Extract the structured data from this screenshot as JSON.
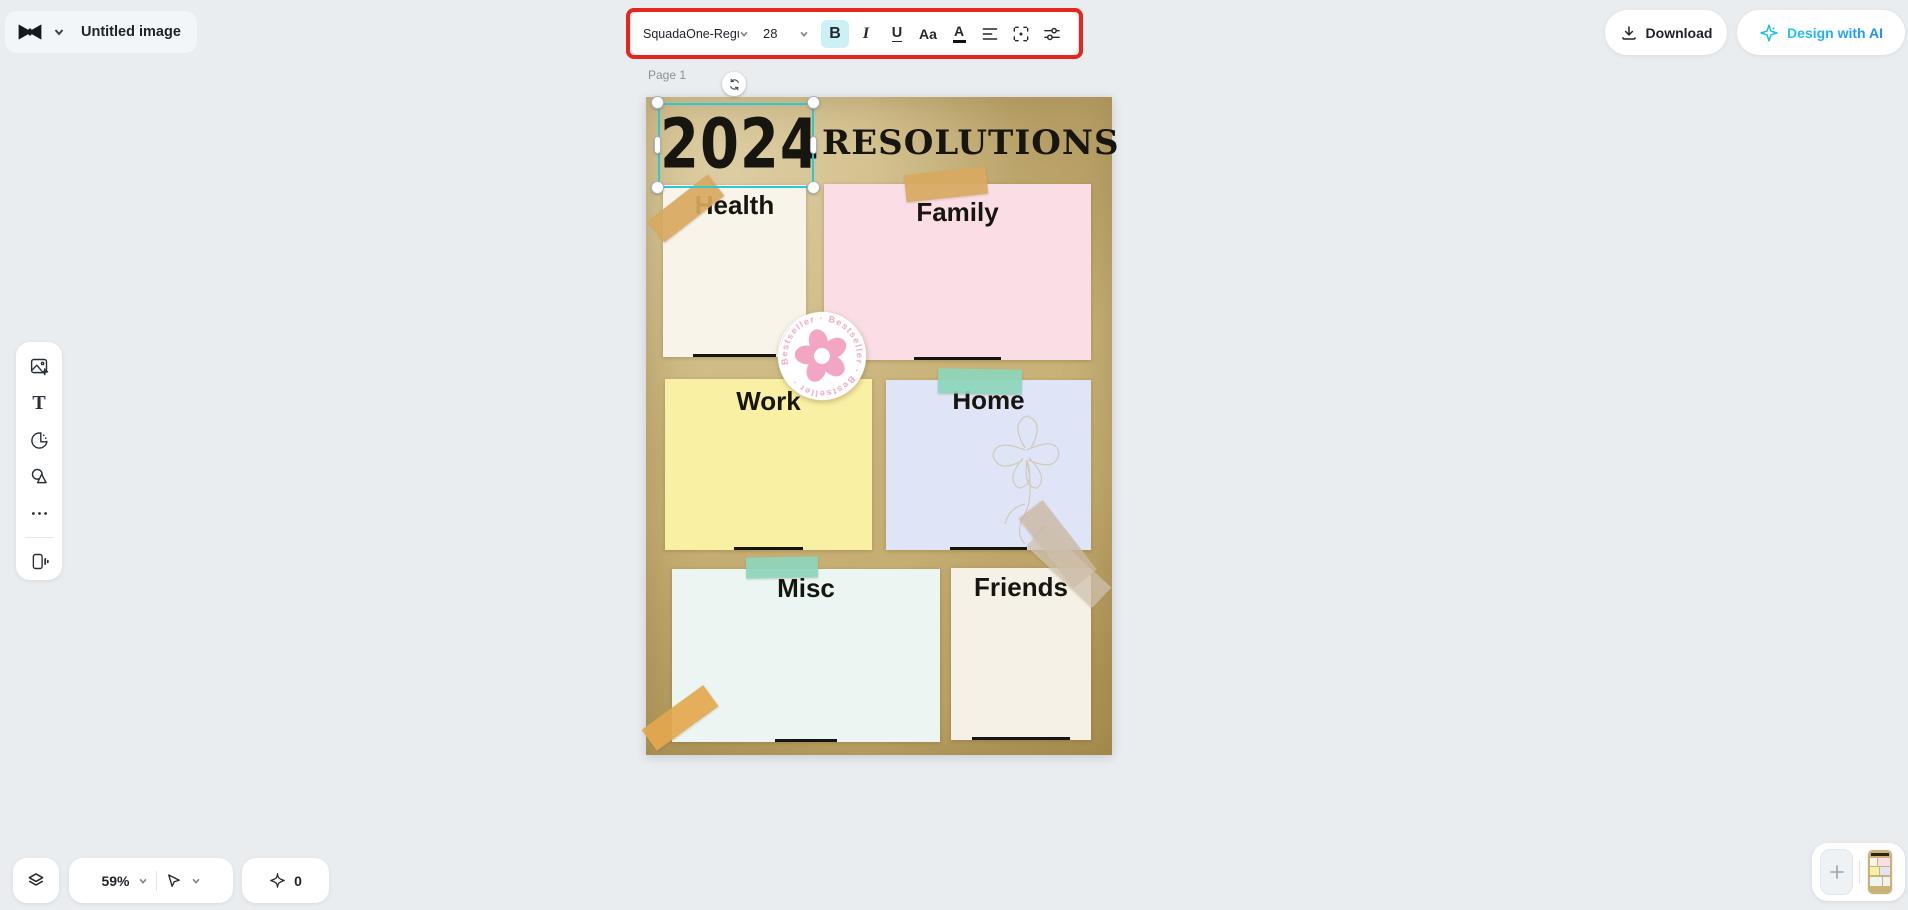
{
  "header": {
    "doc_title": "Untitled image",
    "download_label": "Download",
    "design_ai_label": "Design with AI"
  },
  "toolbar": {
    "font_name": "SquadaOne-Regu",
    "font_size": "28",
    "bold_label": "B",
    "italic_label": "I",
    "underline_label": "U",
    "case_label": "Aa",
    "color_label": "A"
  },
  "canvas": {
    "page_label": "Page 1",
    "title_year": "2024",
    "title_text": "RESOLUTIONS",
    "notes": [
      {
        "label": "Health",
        "color": "#f8f4ea"
      },
      {
        "label": "Family",
        "color": "#fbdde5"
      },
      {
        "label": "Work",
        "color": "#faf0a3"
      },
      {
        "label": "Home",
        "color": "#dfe4f7"
      },
      {
        "label": "Misc",
        "color": "#ebf6f3"
      },
      {
        "label": "Friends",
        "color": "#f6f1e7"
      }
    ],
    "sticker_text": "Bestseller · Bestseller · Bestseller ·"
  },
  "footer": {
    "zoom_level": "59%",
    "credits": "0"
  },
  "colors": {
    "selection_cyan": "#2bc8d8",
    "annotation_red": "#e3261e",
    "ai_cyan": "#15c0e8",
    "parchment": "#c9b379",
    "tape_tan": "#d9a960",
    "tape_teal": "#8ed6bc",
    "tape_orange": "#e5a84f",
    "tape_gray": "#cfc0ac"
  }
}
